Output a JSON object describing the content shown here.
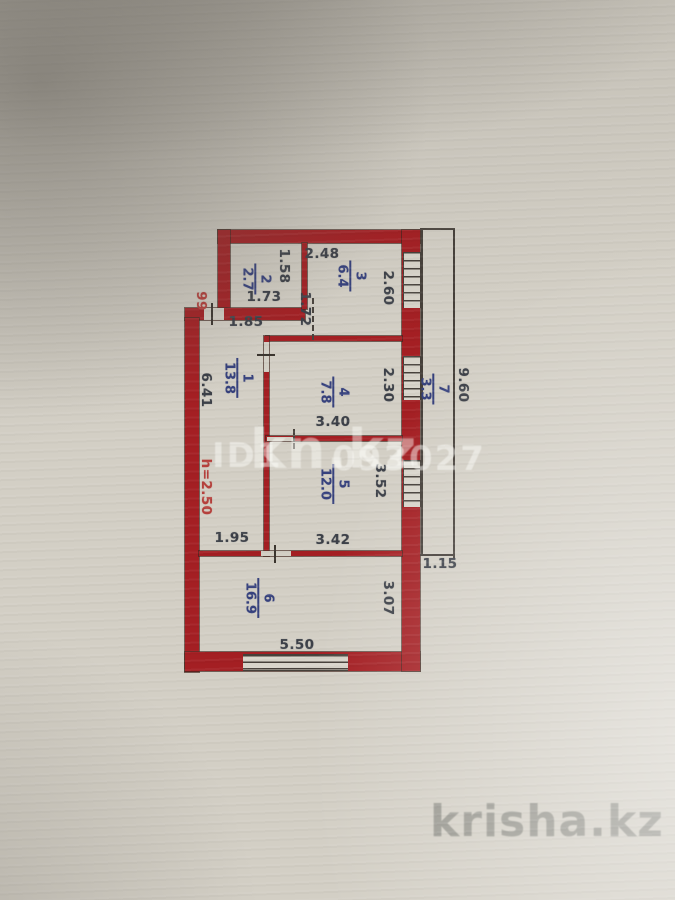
{
  "colors": {
    "paper": "#d3cfc5",
    "wall": "#a41f23",
    "room-label": "#36417d",
    "dimension": "#3c4048",
    "annotation": "#b5403c",
    "corner-watermark": "#8e8e86"
  },
  "plan": {
    "rooms": {
      "r1": {
        "number": "1",
        "area": "13.8"
      },
      "r2": {
        "number": "2",
        "area": "2.7"
      },
      "r3": {
        "number": "3",
        "area": "6.4"
      },
      "r4": {
        "number": "4",
        "area": "7.8"
      },
      "r5": {
        "number": "5",
        "area": "12.0"
      },
      "r6": {
        "number": "6",
        "area": "16.9"
      },
      "r7": {
        "number": "7",
        "area": "3.3"
      }
    },
    "dims": {
      "room3_width_top": "2.48",
      "room2_height": "1.58",
      "room2_width": "1.73",
      "room23_passage": "1.72",
      "hall_top_width": "1.85",
      "room3_height": "2.60",
      "hall_height": "6.41",
      "room4_height": "2.30",
      "room4_width": "3.40",
      "room5_height": "3.52",
      "room5_width": "3.42",
      "hall_bottom_width": "1.95",
      "room6_width": "5.50",
      "room6_height": "3.07",
      "balcony_length": "9.60",
      "balcony_width": "1.15"
    },
    "annotations": {
      "unit_number": "99",
      "ceiling_height": "h=2.50"
    }
  },
  "watermarks": {
    "id_prefix": "ID1",
    "id_suffix": "093027",
    "center_site": "kn.kz",
    "corner_site": "krisha.kz"
  }
}
